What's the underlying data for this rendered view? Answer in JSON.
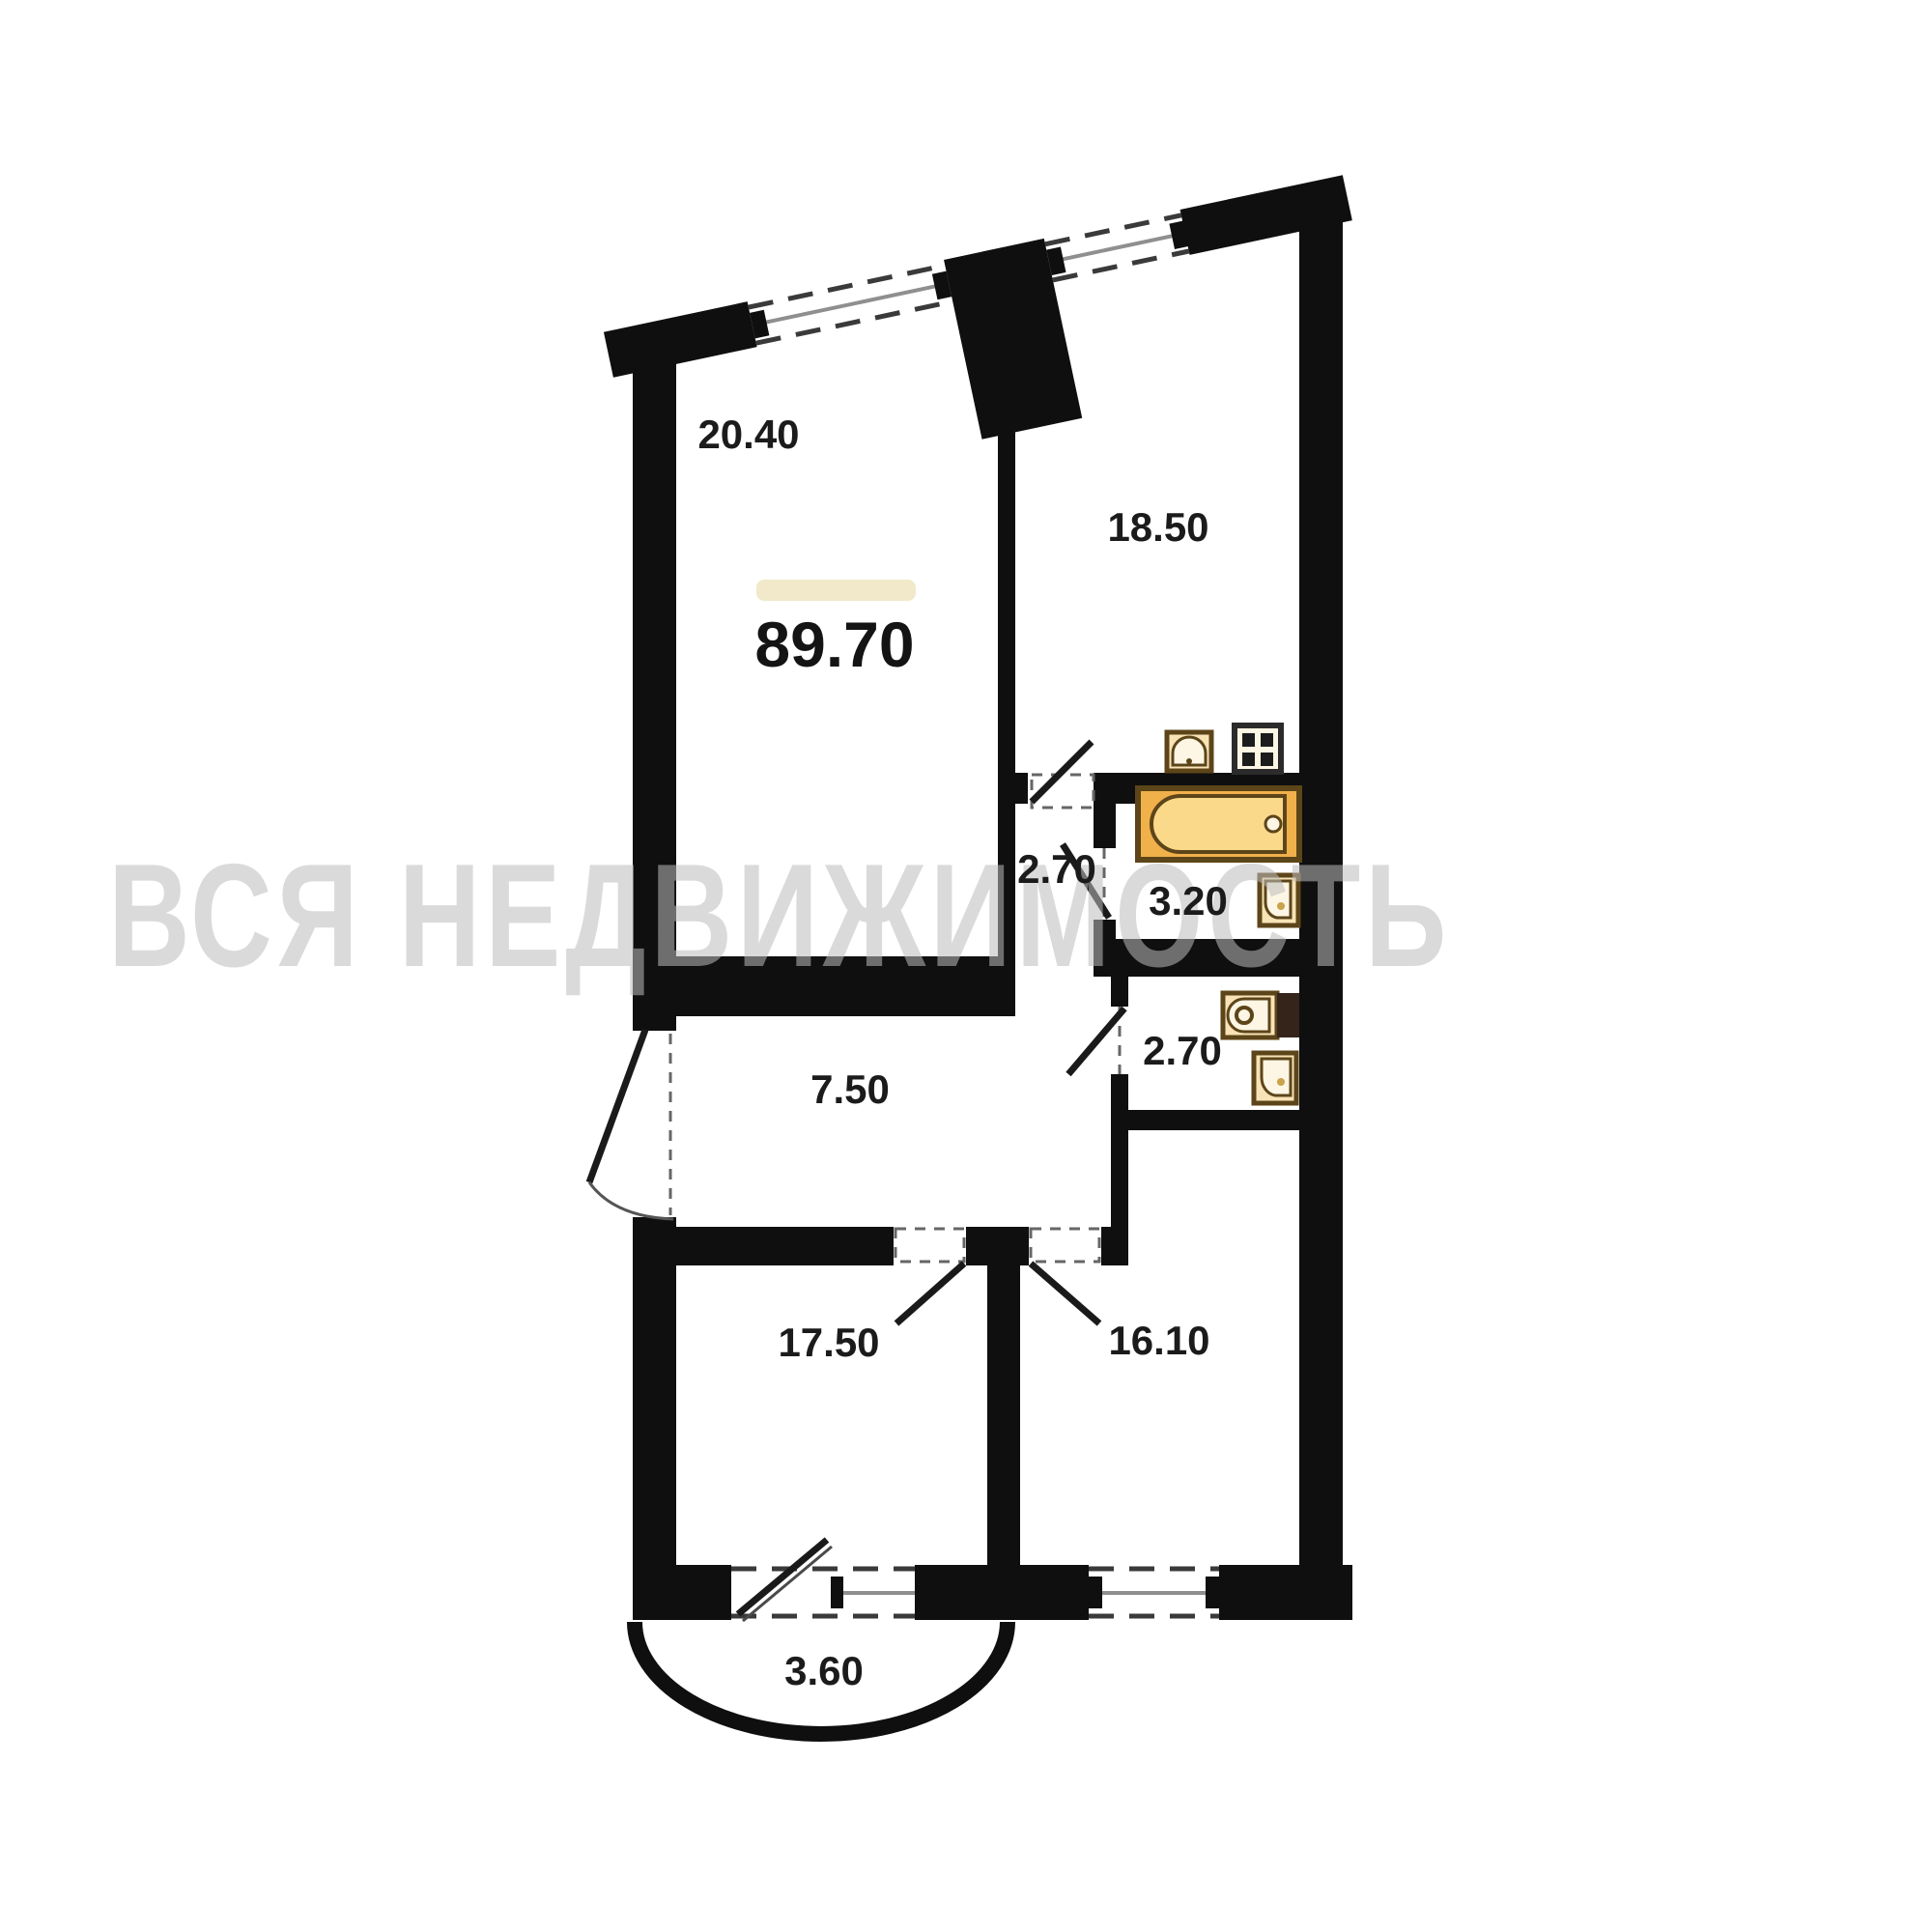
{
  "watermark_text": "ВСЯ НЕДВИЖИМОСТЬ",
  "total_area": "89.70",
  "rooms": [
    {
      "id": "living-room",
      "area": "20.40"
    },
    {
      "id": "kitchen-living-room",
      "area": "18.50"
    },
    {
      "id": "inner-hall",
      "area": "2.70"
    },
    {
      "id": "bathroom",
      "area": "3.20"
    },
    {
      "id": "corridor",
      "area": "7.50"
    },
    {
      "id": "wc",
      "area": "2.70"
    },
    {
      "id": "bedroom-1",
      "area": "17.50"
    },
    {
      "id": "bedroom-2",
      "area": "16.10"
    },
    {
      "id": "balcony",
      "area": "3.60"
    }
  ],
  "fixtures": {
    "bathtub": "bathtub-icon",
    "bathroom_toilet": "toilet-icon",
    "kitchen_sink": "kitchen-sink-icon",
    "stove": "stove-icon",
    "wc_toilet": "toilet-icon",
    "wc_basin": "wash-basin-icon",
    "vent_shaft": "vent-shaft-icon"
  },
  "colors": {
    "wall": "#0f0f0f",
    "bathtub_fill": "#f0b04a",
    "bathtub_inner": "#fbd98b",
    "fixture_fill": "#f7e3b6",
    "highlight_bar": "#f1e9c9",
    "watermark": "#bdbdbd",
    "window_glass_line": "#8f8f8f",
    "label_text": "#1b1b1b"
  }
}
